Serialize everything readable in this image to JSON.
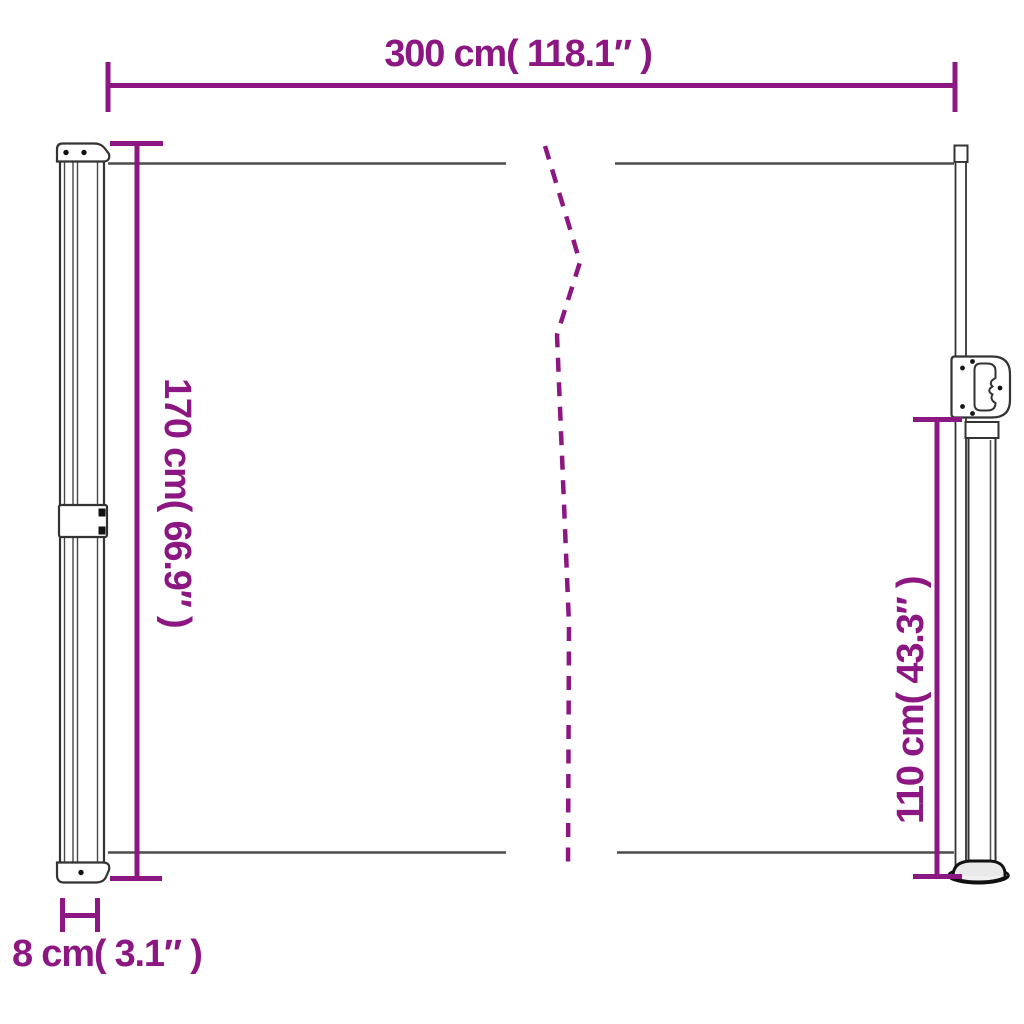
{
  "diagram": {
    "accent_color": "#8D1782",
    "line_color": "#3a3a3a",
    "labels": {
      "total_width": "300 cm( 118.1″ )",
      "left_height": "170 cm( 66.9″ )",
      "right_height": "110 cm( 43.3″ )",
      "depth": "8 cm( 3.1″ )"
    }
  }
}
